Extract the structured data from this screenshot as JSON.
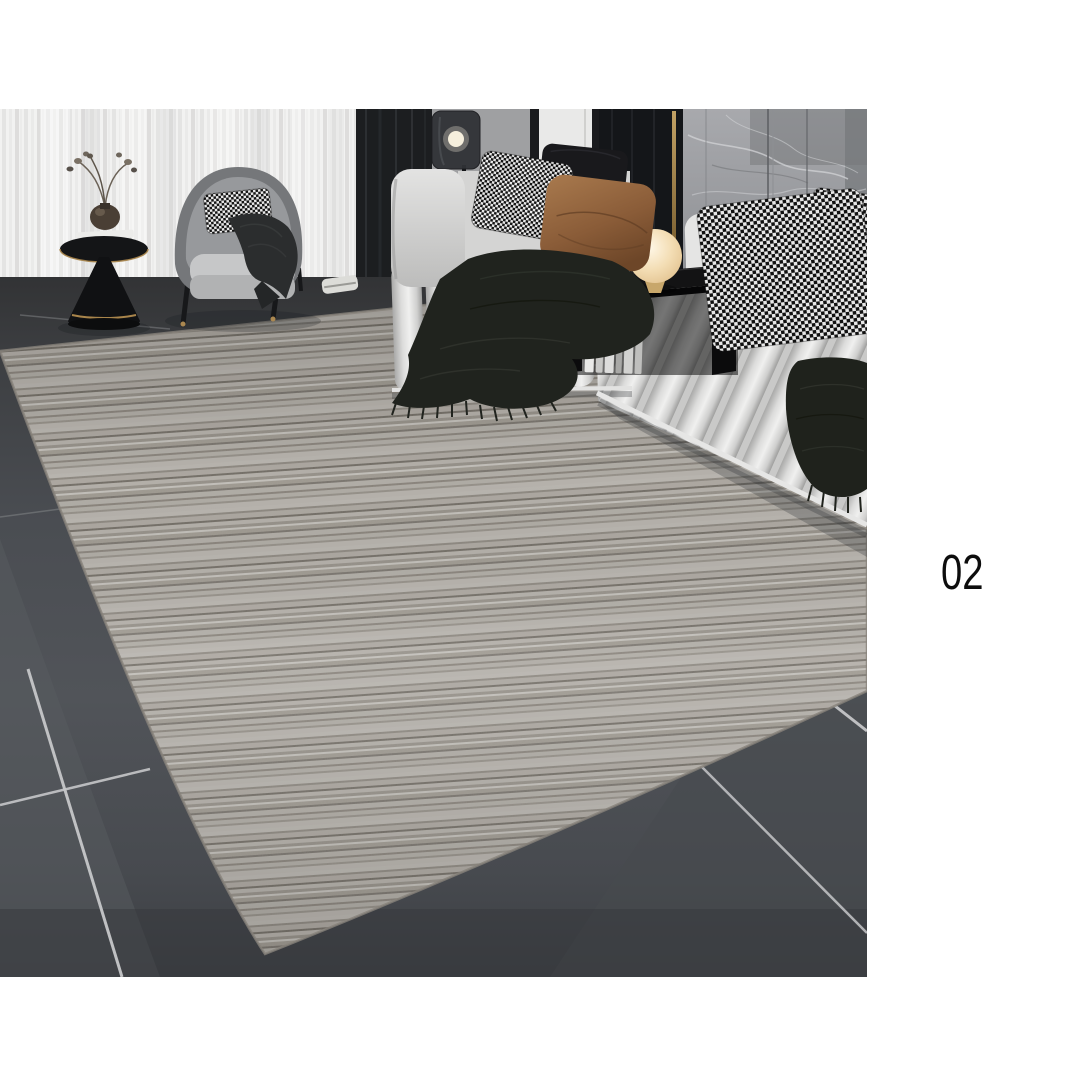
{
  "page": {
    "background_color": "#ffffff"
  },
  "photo": {
    "label": "02",
    "kind": "living-room product photograph of a striated grey area rug",
    "objects": [
      "sheer white curtains",
      "dark charcoal curtain",
      "smoked-glass floor lamp with glowing bulb",
      "grey marble wall panels",
      "channel-tufted light grey sofa",
      "houndstooth cushions",
      "black cushion",
      "brown velvet cushion",
      "cream sphere table lamp",
      "black over-arm console with books",
      "dark green fringed throw blankets",
      "grey tub armchair with houndstooth lumbar pillow",
      "black pedestal side table with vase, dried branches and books",
      "striated grey area rug",
      "dark grey floor tiles with light grout"
    ],
    "palette": {
      "rug_base": "#a5a19a",
      "rug_stripe_dark": "#6f6a62",
      "rug_stripe_light": "#c3c0ba",
      "tile_floor": "#4a4d52",
      "tile_grout": "#c6c7c9",
      "sofa_fabric": "#d6d6d5",
      "armchair_shell": "#75777a",
      "curtain_sheer": "#f1f1f0",
      "curtain_dark": "#1c1e20",
      "marble_wall": "#9b9da1",
      "pillow_brown": "#8a5c38",
      "pillow_black": "#19191c",
      "lamp_glow": "#f3ddb4",
      "accent_gold": "#a9854b",
      "console_black": "#131314",
      "label_color": "#0d0d0d"
    }
  }
}
